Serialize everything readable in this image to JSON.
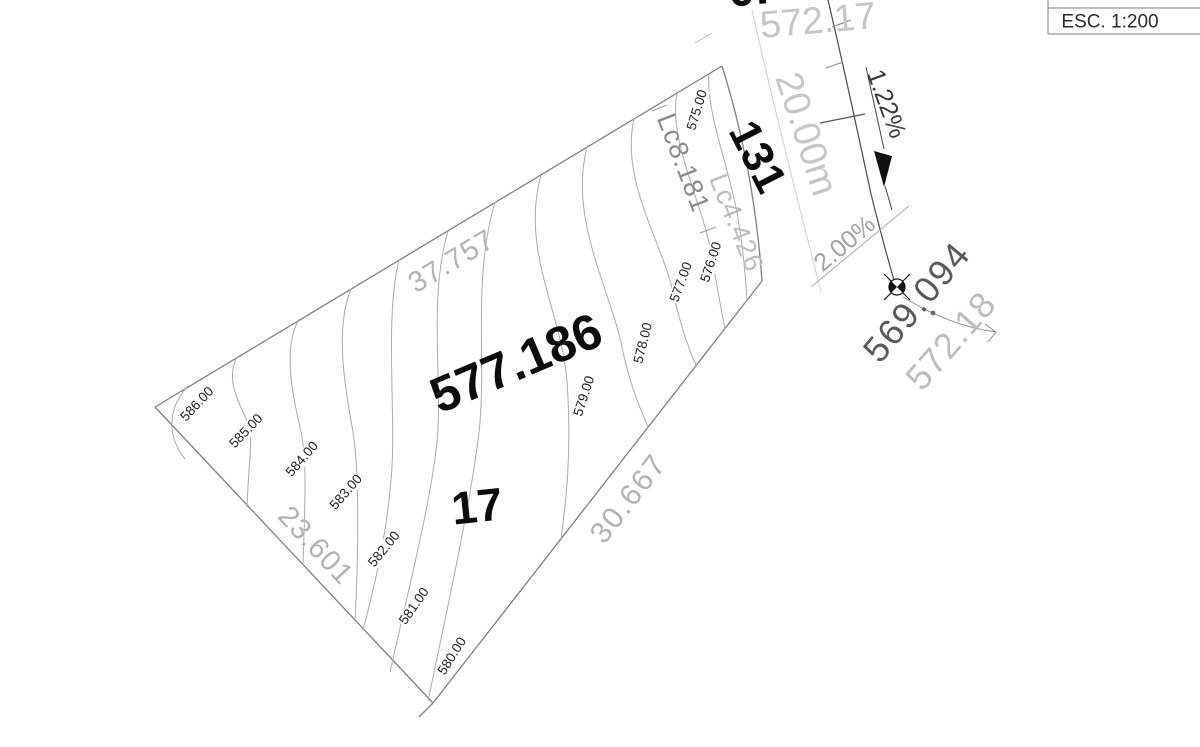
{
  "title_block": {
    "scale_label": "ESC. 1:200"
  },
  "lot": {
    "number": "17",
    "pad_elevation": "577.186",
    "side_nw": "37.757",
    "side_sw": "23.601",
    "side_se": "30.667",
    "curve_1": "Lc8.181",
    "curve_2": "Lc4.426"
  },
  "street": {
    "number": "131",
    "width": "20.00m",
    "grade_long": "1.22%",
    "grade_cross": "2.00%",
    "spot_elev_top": "572.17",
    "spot_elev_top_partial": "0.",
    "bench_elev_1": "569.094",
    "bench_elev_2": "572.18"
  },
  "contours": {
    "labels": [
      "586.00",
      "585.00",
      "584.00",
      "583.00",
      "582.00",
      "581.00",
      "580.00",
      "579.00",
      "578.00",
      "577.00",
      "576.00",
      "575.00"
    ]
  },
  "colors": {
    "contour_line": "#ababab",
    "boundary": "#808080",
    "road_edge": "#4a4a4a",
    "centerline": "#cfcfcf",
    "dark_text": "#0c0c0c",
    "dim_text": "#b3b3b3",
    "bench_text": "#5a5a5a"
  }
}
